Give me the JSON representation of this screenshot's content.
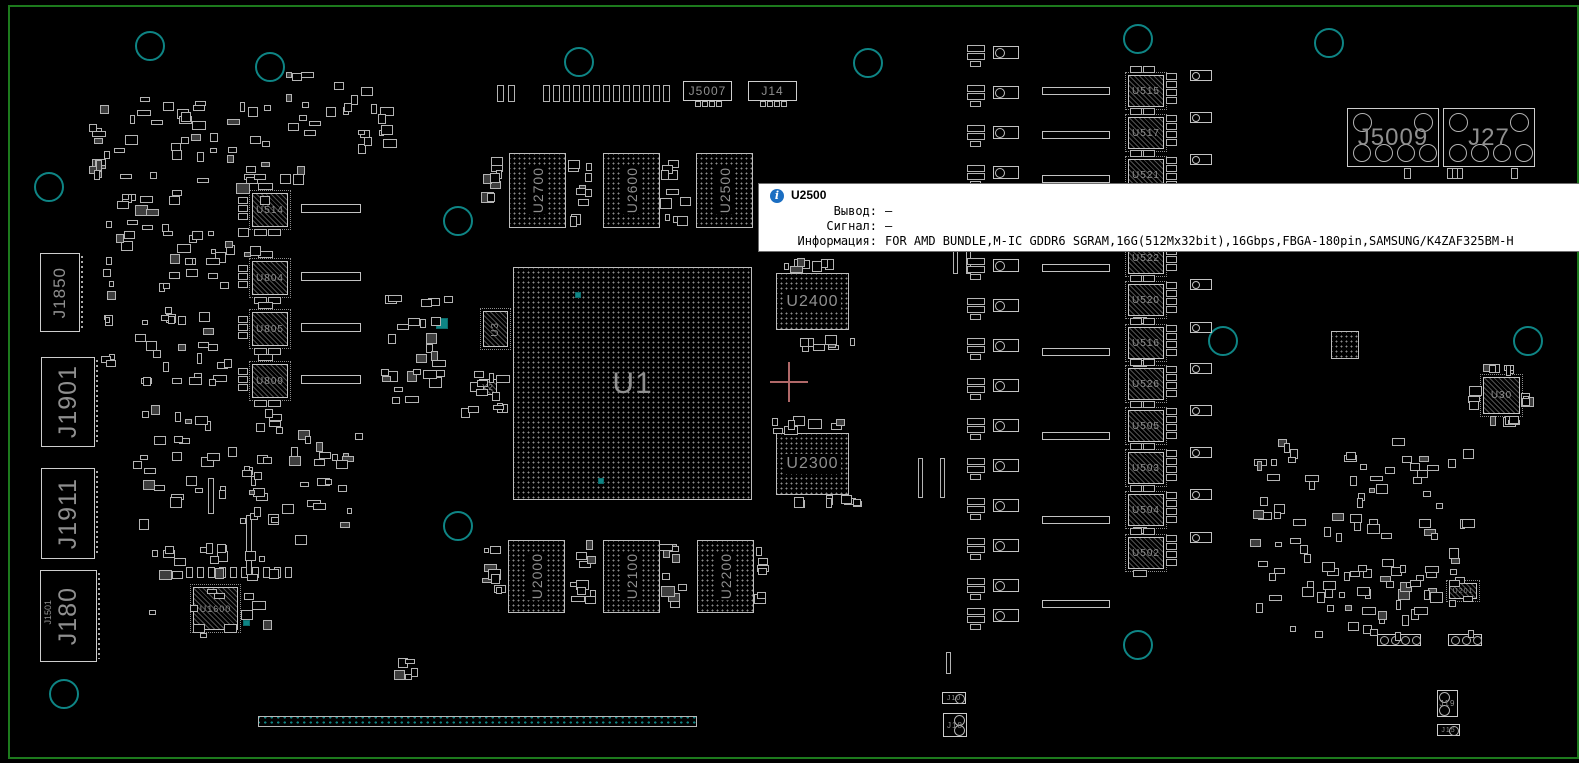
{
  "colors": {
    "background": "#000000",
    "board_outline": "#1d7a1d",
    "component_outline": "#c0c0c0",
    "label": "#8f8f8f",
    "hole_teal": "#0e8585",
    "crosshair": "#b06868",
    "tooltip_bg": "#ffffff",
    "tooltip_text": "#000000",
    "info_icon_blue": "#1b6ec2"
  },
  "tooltip": {
    "icon": "info-icon",
    "component": "U2500",
    "rows": [
      {
        "label": "Вывод:",
        "value": "—"
      },
      {
        "label": "Сигнал:",
        "value": "—"
      },
      {
        "label": "Информация:",
        "value": "FOR AMD BUNDLE,M-IC GDDR6 SGRAM,16G(512Mx32bit),16Gbps,FBGA-180pin,SAMSUNG/K4ZAF325BM-H"
      }
    ]
  },
  "board": {
    "bga_chips": [
      {
        "label": "U1",
        "x": 513,
        "y": 267,
        "w": 237,
        "h": 231,
        "fs": 30,
        "vert": false,
        "band": false
      },
      {
        "label": "U2700",
        "x": 509,
        "y": 153,
        "w": 55,
        "h": 73,
        "fs": 14,
        "vert": true,
        "band": true
      },
      {
        "label": "U2600",
        "x": 603,
        "y": 153,
        "w": 55,
        "h": 73,
        "fs": 14,
        "vert": true,
        "band": true
      },
      {
        "label": "U2500",
        "x": 696,
        "y": 153,
        "w": 55,
        "h": 73,
        "fs": 14,
        "vert": true,
        "band": true
      },
      {
        "label": "U2000",
        "x": 508,
        "y": 540,
        "w": 55,
        "h": 71,
        "fs": 14,
        "vert": true,
        "band": true
      },
      {
        "label": "U2100",
        "x": 603,
        "y": 540,
        "w": 55,
        "h": 71,
        "fs": 14,
        "vert": true,
        "band": true
      },
      {
        "label": "U2200",
        "x": 697,
        "y": 540,
        "w": 55,
        "h": 71,
        "fs": 14,
        "vert": true,
        "band": true
      },
      {
        "label": "U2400",
        "x": 776,
        "y": 273,
        "w": 71,
        "h": 55,
        "fs": 16,
        "vert": false,
        "band": true
      },
      {
        "label": "U2300",
        "x": 776,
        "y": 433,
        "w": 71,
        "h": 60,
        "fs": 16,
        "vert": false,
        "band": true
      },
      {
        "label": "",
        "x": 1331,
        "y": 331,
        "w": 26,
        "h": 26,
        "fs": 0,
        "vert": false,
        "band": false
      }
    ],
    "qfn_chips": [
      {
        "label": "U514",
        "x": 252,
        "y": 193,
        "w": 34,
        "h": 32,
        "fs": 10
      },
      {
        "label": "U804",
        "x": 252,
        "y": 261,
        "w": 34,
        "h": 32,
        "fs": 10
      },
      {
        "label": "U805",
        "x": 252,
        "y": 312,
        "w": 34,
        "h": 32,
        "fs": 10
      },
      {
        "label": "U809",
        "x": 252,
        "y": 364,
        "w": 34,
        "h": 32,
        "fs": 10
      },
      {
        "label": "U1600",
        "x": 193,
        "y": 587,
        "w": 43,
        "h": 41,
        "fs": 9
      },
      {
        "label": "U3",
        "x": 483,
        "y": 311,
        "w": 23,
        "h": 34,
        "fs": 10,
        "vert": true
      },
      {
        "label": "Y2",
        "x": 479,
        "y": 379,
        "w": 16,
        "h": 14,
        "fs": 8
      },
      {
        "label": "U30",
        "x": 1483,
        "y": 377,
        "w": 35,
        "h": 35,
        "fs": 10
      },
      {
        "label": "U201",
        "x": 1449,
        "y": 583,
        "w": 26,
        "h": 14,
        "fs": 7
      },
      {
        "label": "U515",
        "x": 1128,
        "y": 75,
        "w": 34,
        "h": 30,
        "fs": 10
      },
      {
        "label": "U517",
        "x": 1128,
        "y": 117,
        "w": 34,
        "h": 30,
        "fs": 10
      },
      {
        "label": "U521",
        "x": 1128,
        "y": 159,
        "w": 34,
        "h": 30,
        "fs": 10
      },
      {
        "label": "U522",
        "x": 1128,
        "y": 242,
        "w": 34,
        "h": 30,
        "fs": 10
      },
      {
        "label": "U520",
        "x": 1128,
        "y": 284,
        "w": 34,
        "h": 30,
        "fs": 10
      },
      {
        "label": "U516",
        "x": 1128,
        "y": 327,
        "w": 34,
        "h": 30,
        "fs": 10
      },
      {
        "label": "U526",
        "x": 1128,
        "y": 368,
        "w": 34,
        "h": 30,
        "fs": 10
      },
      {
        "label": "U505",
        "x": 1128,
        "y": 410,
        "w": 34,
        "h": 30,
        "fs": 10
      },
      {
        "label": "U503",
        "x": 1128,
        "y": 452,
        "w": 34,
        "h": 30,
        "fs": 10
      },
      {
        "label": "U504",
        "x": 1128,
        "y": 494,
        "w": 34,
        "h": 30,
        "fs": 10
      },
      {
        "label": "U502",
        "x": 1128,
        "y": 537,
        "w": 34,
        "h": 30,
        "fs": 10
      }
    ],
    "connectors": [
      {
        "label": "J5007",
        "x": 683,
        "y": 81,
        "w": 47,
        "h": 18,
        "fs": 12,
        "vert": false,
        "style": "pins"
      },
      {
        "label": "J14",
        "x": 748,
        "y": 81,
        "w": 47,
        "h": 18,
        "fs": 12,
        "vert": false,
        "style": "pins"
      },
      {
        "label": "J5009",
        "x": 1347,
        "y": 108,
        "w": 90,
        "h": 57,
        "fs": 24,
        "vert": false,
        "style": "disp"
      },
      {
        "label": "J27",
        "x": 1443,
        "y": 108,
        "w": 90,
        "h": 57,
        "fs": 24,
        "vert": false,
        "style": "disp"
      },
      {
        "label": "J1850",
        "x": 40,
        "y": 253,
        "w": 38,
        "h": 77,
        "fs": 17,
        "vert": true,
        "style": "ser"
      },
      {
        "label": "J1901",
        "x": 41,
        "y": 357,
        "w": 52,
        "h": 88,
        "fs": 25,
        "vert": true,
        "style": "ser"
      },
      {
        "label": "J1911",
        "x": 41,
        "y": 468,
        "w": 52,
        "h": 89,
        "fs": 25,
        "vert": true,
        "style": "ser"
      },
      {
        "label": "J180",
        "x": 40,
        "y": 570,
        "w": 55,
        "h": 90,
        "fs": 25,
        "vert": true,
        "style": "ser",
        "extra": "J1501"
      },
      {
        "label": "J10",
        "x": 942,
        "y": 692,
        "w": 22,
        "h": 10,
        "fs": 7,
        "vert": false,
        "style": "c1"
      },
      {
        "label": "J18",
        "x": 943,
        "y": 713,
        "w": 22,
        "h": 22,
        "fs": 8,
        "vert": false,
        "style": "c2r"
      },
      {
        "label": "J19",
        "x": 1437,
        "y": 690,
        "w": 19,
        "h": 25,
        "fs": 8,
        "vert": false,
        "style": "c2l"
      },
      {
        "label": "J15",
        "x": 1437,
        "y": 724,
        "w": 21,
        "h": 10,
        "fs": 7,
        "vert": false,
        "style": "c1"
      }
    ]
  }
}
